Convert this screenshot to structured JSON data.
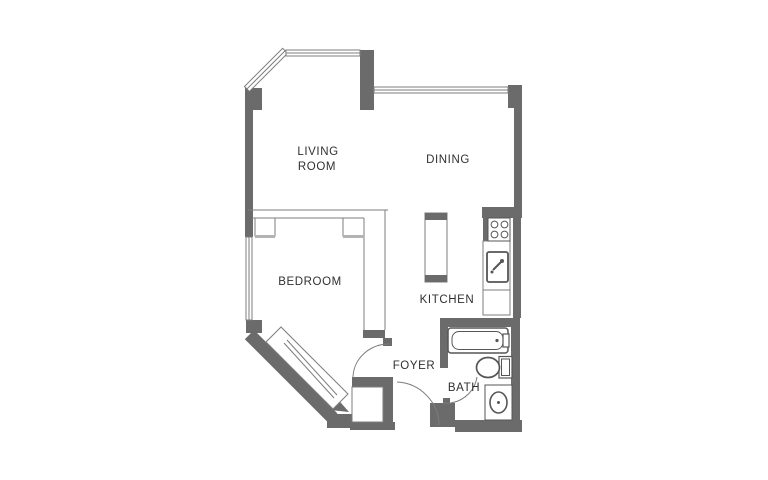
{
  "title": "Studio apartment floor plan",
  "colors": {
    "background": "#ffffff",
    "wall": "#6b6b6b",
    "line": "#7c7c7c",
    "fixture": "#565656",
    "light": "#b3b3b3",
    "text": "#303030"
  },
  "rooms": {
    "living_room": {
      "line1": "LIVING",
      "line2": "ROOM"
    },
    "dining": {
      "label": "DINING"
    },
    "bedroom": {
      "label": "BEDROOM"
    },
    "kitchen": {
      "label": "KITCHEN"
    },
    "foyer": {
      "label": "FOYER"
    },
    "bath": {
      "label": "BATH"
    }
  },
  "fixtures": {
    "kitchen": [
      "stove-icon",
      "kitchen-sink-icon",
      "kitchen-counter",
      "kitchen-island"
    ],
    "bath": [
      "bathtub-icon",
      "toilet-icon",
      "vanity-sink-icon"
    ],
    "bedroom": [
      "sliding-closet-door",
      "entry-closet"
    ],
    "openings": [
      "bay-window",
      "living-room-window",
      "dining-window",
      "bedroom-window",
      "bedroom-door-arc",
      "entry-door-arc",
      "bath-door-arc"
    ]
  }
}
